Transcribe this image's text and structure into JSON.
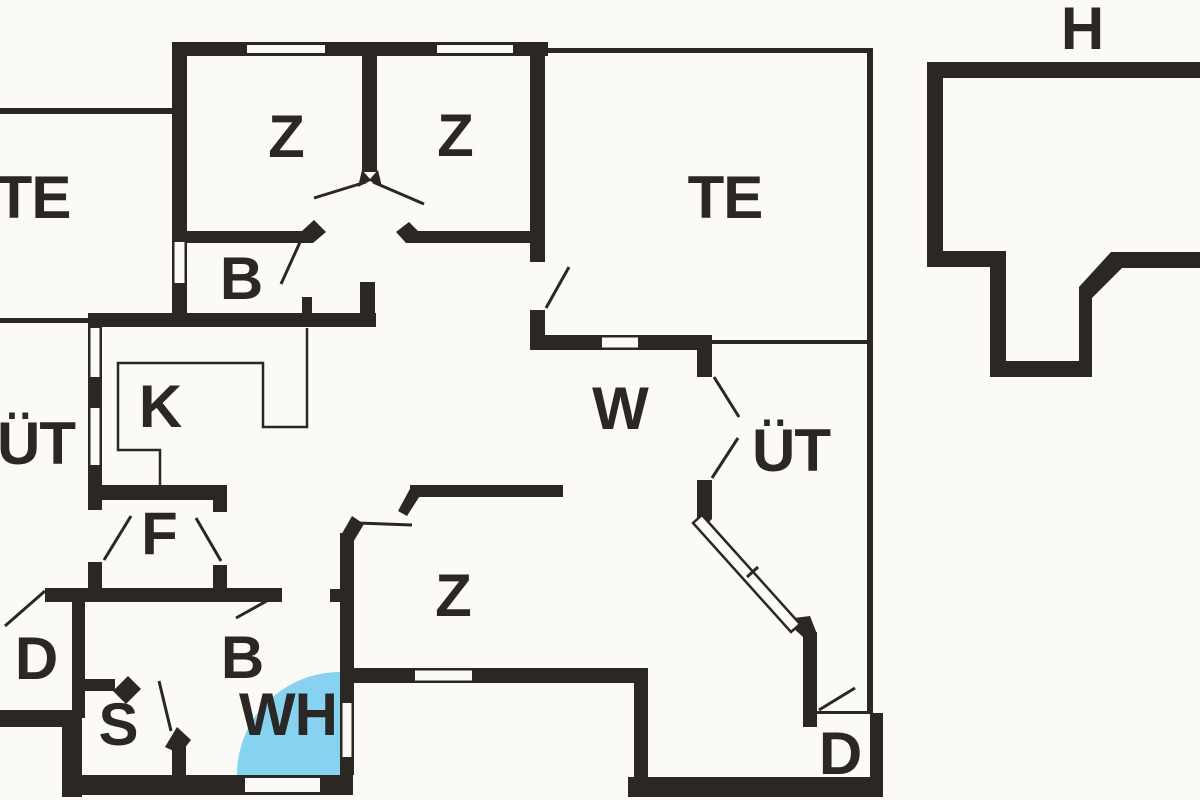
{
  "figure": {
    "type": "floor-plan",
    "description": "Black and white architectural floor plan with one highlighted quarter-circle area"
  },
  "colors": {
    "background": "#fbfaf6",
    "wall": "#2b2723",
    "highlight": "#86d2f1"
  },
  "rooms": [
    {
      "id": "room-te-left",
      "label": "TE"
    },
    {
      "id": "room-z-top-left",
      "label": "Z"
    },
    {
      "id": "room-z-top-right",
      "label": "Z"
    },
    {
      "id": "room-b-top",
      "label": "B"
    },
    {
      "id": "room-te-right",
      "label": "TE"
    },
    {
      "id": "room-h",
      "label": "H"
    },
    {
      "id": "room-ut-left",
      "label": "ÜT"
    },
    {
      "id": "room-k",
      "label": "K"
    },
    {
      "id": "room-w",
      "label": "W"
    },
    {
      "id": "room-ut-right",
      "label": "ÜT"
    },
    {
      "id": "room-f",
      "label": "F"
    },
    {
      "id": "room-z-bottom",
      "label": "Z"
    },
    {
      "id": "room-d-left",
      "label": "D"
    },
    {
      "id": "room-s",
      "label": "S"
    },
    {
      "id": "room-b-bottom",
      "label": "B"
    },
    {
      "id": "room-wh",
      "label": "WH"
    },
    {
      "id": "room-d-right",
      "label": "D"
    }
  ]
}
